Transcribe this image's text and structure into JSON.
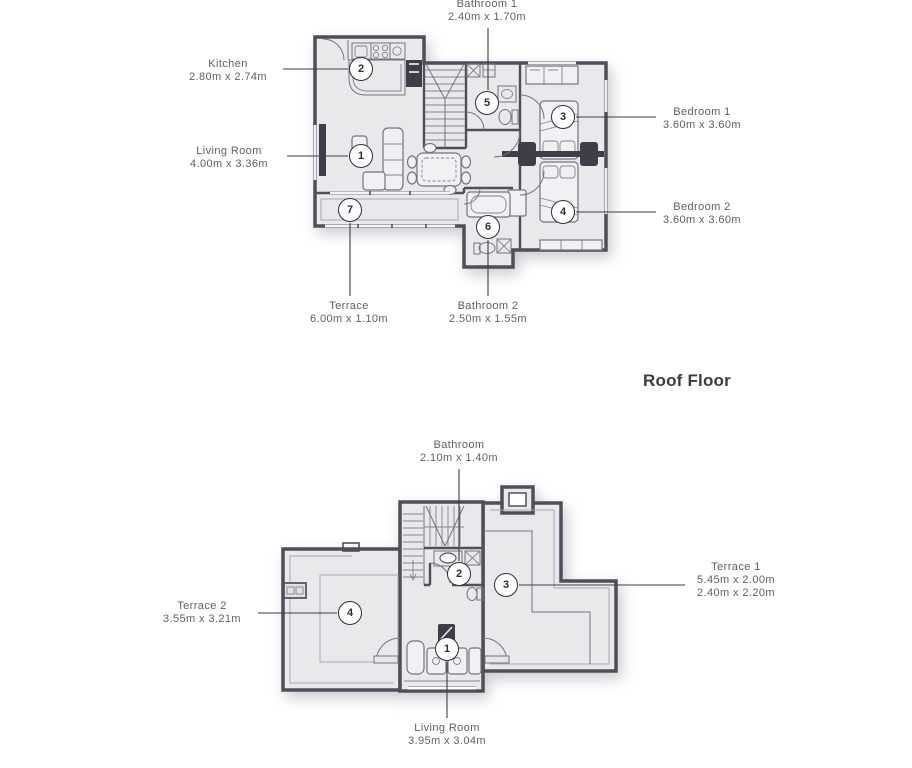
{
  "section_title": "Roof Floor",
  "colors": {
    "wall": "#4e4f59",
    "floor_fill": "#e9e9eb",
    "furniture_line": "#73747e",
    "label_text": "#5f5f61",
    "title_text": "#3c3c3e",
    "background": "#ffffff"
  },
  "upper_floor": {
    "markers": {
      "living": "1",
      "kitchen": "2",
      "bedroom1": "3",
      "bedroom2": "4",
      "bathroom1": "5",
      "bathroom2": "6",
      "terrace": "7"
    },
    "labels": {
      "bathroom1": {
        "name": "Bathroom 1",
        "dims": "2.40m x 1.70m"
      },
      "kitchen": {
        "name": "Kitchen",
        "dims": "2.80m x 2.74m"
      },
      "living": {
        "name": "Living Room",
        "dims": "4.00m x 3.36m"
      },
      "bedroom1": {
        "name": "Bedroom 1",
        "dims": "3.60m x 3.60m"
      },
      "bedroom2": {
        "name": "Bedroom 2",
        "dims": "3.60m x 3.60m"
      },
      "terrace": {
        "name": "Terrace",
        "dims": "6.00m x 1.10m"
      },
      "bathroom2": {
        "name": "Bathroom 2",
        "dims": "2.50m x 1.55m"
      }
    }
  },
  "roof_floor": {
    "markers": {
      "living": "1",
      "bathroom": "2",
      "terrace1": "3",
      "terrace2": "4"
    },
    "labels": {
      "bathroom": {
        "name": "Bathroom",
        "dims": "2.10m x 1.40m"
      },
      "terrace1": {
        "name": "Terrace 1",
        "dims": "5.45m x 2.00m",
        "dims2": "2.40m x 2.20m"
      },
      "terrace2": {
        "name": "Terrace 2",
        "dims": "3.55m x 3.21m"
      },
      "living": {
        "name": "Living Room",
        "dims": "3.95m x 3.04m"
      }
    }
  }
}
